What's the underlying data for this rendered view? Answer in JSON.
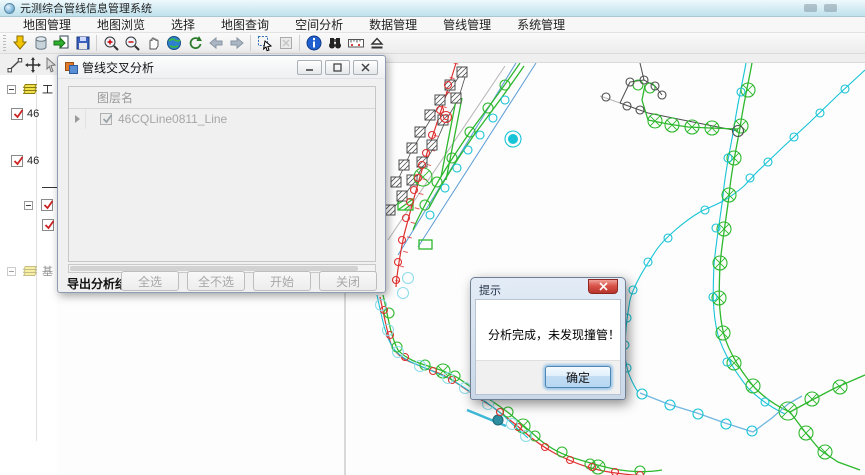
{
  "window": {
    "title": "元测综合管线信息管理系统"
  },
  "menu_bar": {
    "items": [
      "地图管理",
      "地图浏览",
      "选择",
      "地图查询",
      "空间分析",
      "数据管理",
      "管线管理",
      "系统管理"
    ]
  },
  "main_toolbar": {
    "icons": [
      "add-data-icon",
      "database-icon",
      "export-icon",
      "save-icon",
      "zoom-in-icon",
      "zoom-out-icon",
      "pan-icon",
      "full-extent-icon",
      "refresh-icon",
      "back-icon",
      "forward-icon",
      "select-icon",
      "clear-selection-icon",
      "identify-icon",
      "find-icon",
      "measure-icon",
      "overlay-icon"
    ]
  },
  "edit_toolbar": {
    "icons": [
      "draw-line-icon",
      "move-icon",
      "select-arrow-icon"
    ]
  },
  "layer_panel": {
    "items": [
      {
        "type": "group",
        "label": "工",
        "checked": false
      },
      {
        "type": "layer",
        "label": "46",
        "checked": true
      },
      {
        "type": "layer",
        "label": "46",
        "checked": true
      },
      {
        "type": "symbol",
        "label": ""
      },
      {
        "type": "group2",
        "label": "",
        "checked": false
      },
      {
        "type": "layer2",
        "label": "",
        "checked": false
      },
      {
        "type": "groupf",
        "label": "基",
        "checked": false
      }
    ]
  },
  "analysis_dialog": {
    "title": "管线交叉分析",
    "grid_header": "图层名",
    "rows": [
      {
        "label": "46CQLine0811_Line",
        "checked": true
      }
    ],
    "footer_label": "导出分析结果...",
    "buttons": [
      {
        "label": "全选",
        "enabled": false
      },
      {
        "label": "全不选",
        "enabled": false
      },
      {
        "label": "开始",
        "enabled": false
      },
      {
        "label": "关闭",
        "enabled": false
      }
    ]
  },
  "message_box": {
    "title": "提示",
    "message": "分析完成，未发现撞管！",
    "ok_label": "确定"
  },
  "map": {
    "colors": {
      "pipeline_green": "#2eb82e",
      "pipeline_red": "#e03030",
      "pipeline_cyan": "#17c3d6",
      "pipeline_pale_cyan": "#8fdde9",
      "pipeline_lightblue": "#6fb7e0",
      "structure_dark": "#4d4d4d",
      "parcel_gray": "#b5b5b5"
    }
  }
}
